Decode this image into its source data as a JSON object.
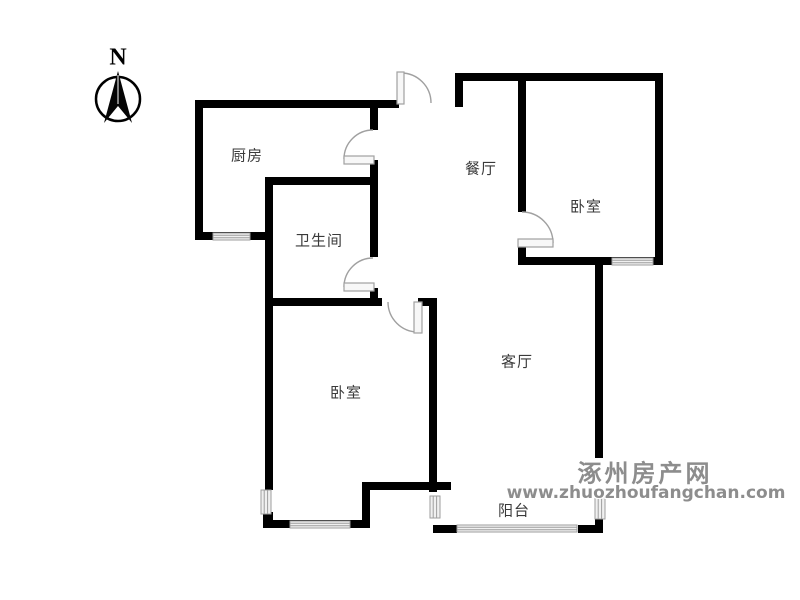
{
  "compass": {
    "label": "N"
  },
  "rooms": [
    {
      "id": "kitchen",
      "label": "厨房"
    },
    {
      "id": "bathroom",
      "label": "卫生间"
    },
    {
      "id": "dining-room",
      "label": "餐厅"
    },
    {
      "id": "bedroom-north",
      "label": "卧室"
    },
    {
      "id": "living-room",
      "label": "客厅"
    },
    {
      "id": "bedroom-south",
      "label": "卧室"
    },
    {
      "id": "balcony",
      "label": "阳台"
    }
  ],
  "watermark": {
    "site_name": "涿州房产网",
    "site_url": "www.zhuozhoufangchan.com"
  },
  "colors": {
    "wall": "#000000",
    "window-fill": "#f0f0f0",
    "window-stroke": "#9e9e9e",
    "door": "#a0a0a0",
    "label": "#3a3a3a",
    "watermark": "#8d8d8d"
  }
}
